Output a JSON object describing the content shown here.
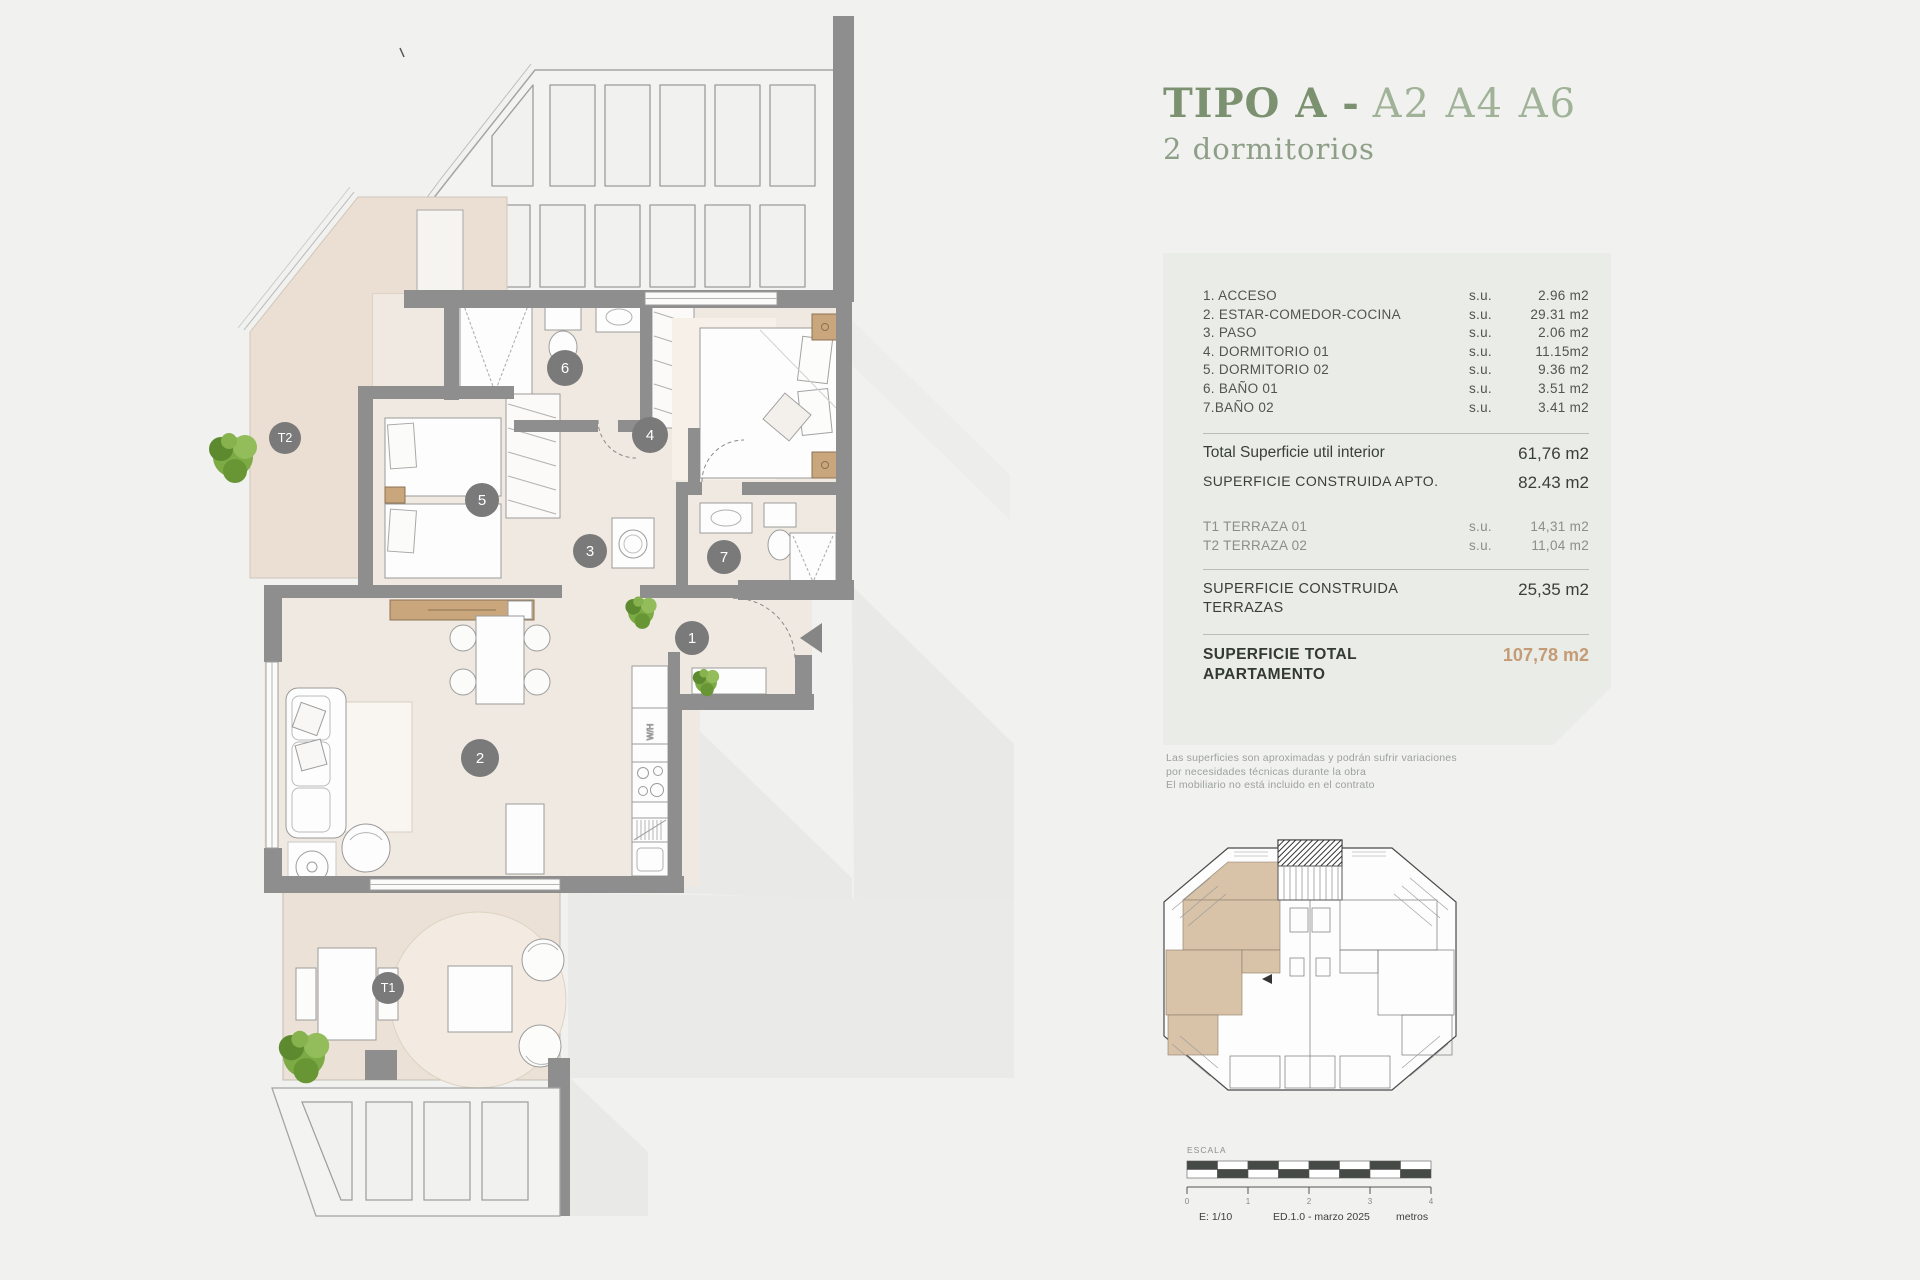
{
  "header": {
    "title_bold": "TIPO A -",
    "title_light": "A2 A4 A6",
    "subtitle": "2 dormitorios"
  },
  "panel": {
    "rooms": [
      {
        "label": "1. ACCESO",
        "su": "s.u.",
        "value": "2.96 m2"
      },
      {
        "label": "2. ESTAR-COMEDOR-COCINA",
        "su": "s.u.",
        "value": "29.31 m2"
      },
      {
        "label": "3. PASO",
        "su": "s.u.",
        "value": "2.06 m2"
      },
      {
        "label": "4. DORMITORIO 01",
        "su": "s.u.",
        "value": "11.15m2"
      },
      {
        "label": "5. DORMITORIO 02",
        "su": "s.u.",
        "value": "9.36 m2"
      },
      {
        "label": "6. BAÑO 01",
        "su": "s.u.",
        "value": "3.51 m2"
      },
      {
        "label": "7.BAÑO 02",
        "su": "s.u.",
        "value": "3.41 m2"
      }
    ],
    "total_interior": {
      "label": "Total Superficie util interior",
      "value": "61,76 m2"
    },
    "construida_apto": {
      "label": "SUPERFICIE CONSTRUIDA APTO.",
      "value": "82.43 m2"
    },
    "terraces": [
      {
        "label": "T1 TERRAZA 01",
        "su": "s.u.",
        "value": "14,31 m2"
      },
      {
        "label": "T2 TERRAZA 02",
        "su": "s.u.",
        "value": "11,04 m2"
      }
    ],
    "construida_terrazas": {
      "label_line1": "SUPERFICIE CONSTRUIDA",
      "label_line2": "TERRAZAS",
      "value": "25,35 m2"
    },
    "total_apartamento": {
      "label_line1": "SUPERFICIE TOTAL",
      "label_line2": "APARTAMENTO",
      "value": "107,78 m2"
    }
  },
  "disclaimer": {
    "line1": "Las superficies son aproximadas y podrán sufrir variaciones",
    "line2": "por necesidades técnicas durante la obra",
    "line3": "El mobiliario no está incluido en el contrato"
  },
  "plan": {
    "markers": [
      {
        "label": "1"
      },
      {
        "label": "2"
      },
      {
        "label": "3"
      },
      {
        "label": "4"
      },
      {
        "label": "5"
      },
      {
        "label": "6"
      },
      {
        "label": "7"
      },
      {
        "label": "T1"
      },
      {
        "label": "T2"
      }
    ],
    "kitchen_label": "W/H"
  },
  "scalebar": {
    "title": "ESCALA",
    "ticks": [
      "0",
      "1",
      "2",
      "3",
      "4"
    ],
    "scale": "E: 1/10",
    "edition": "ED.1.0 - marzo 2025",
    "units": "metros"
  },
  "colors": {
    "accent_green": "#7b9170",
    "accent_green_light": "#a0b297",
    "panel_bg": "#e9ece7",
    "total_accent": "#c59b76",
    "wall_gray": "#8e8e8e",
    "terrace_beige": "#ebdfd3",
    "interior_beige": "#f0e9e1",
    "marker_gray": "#7a7a7a"
  }
}
